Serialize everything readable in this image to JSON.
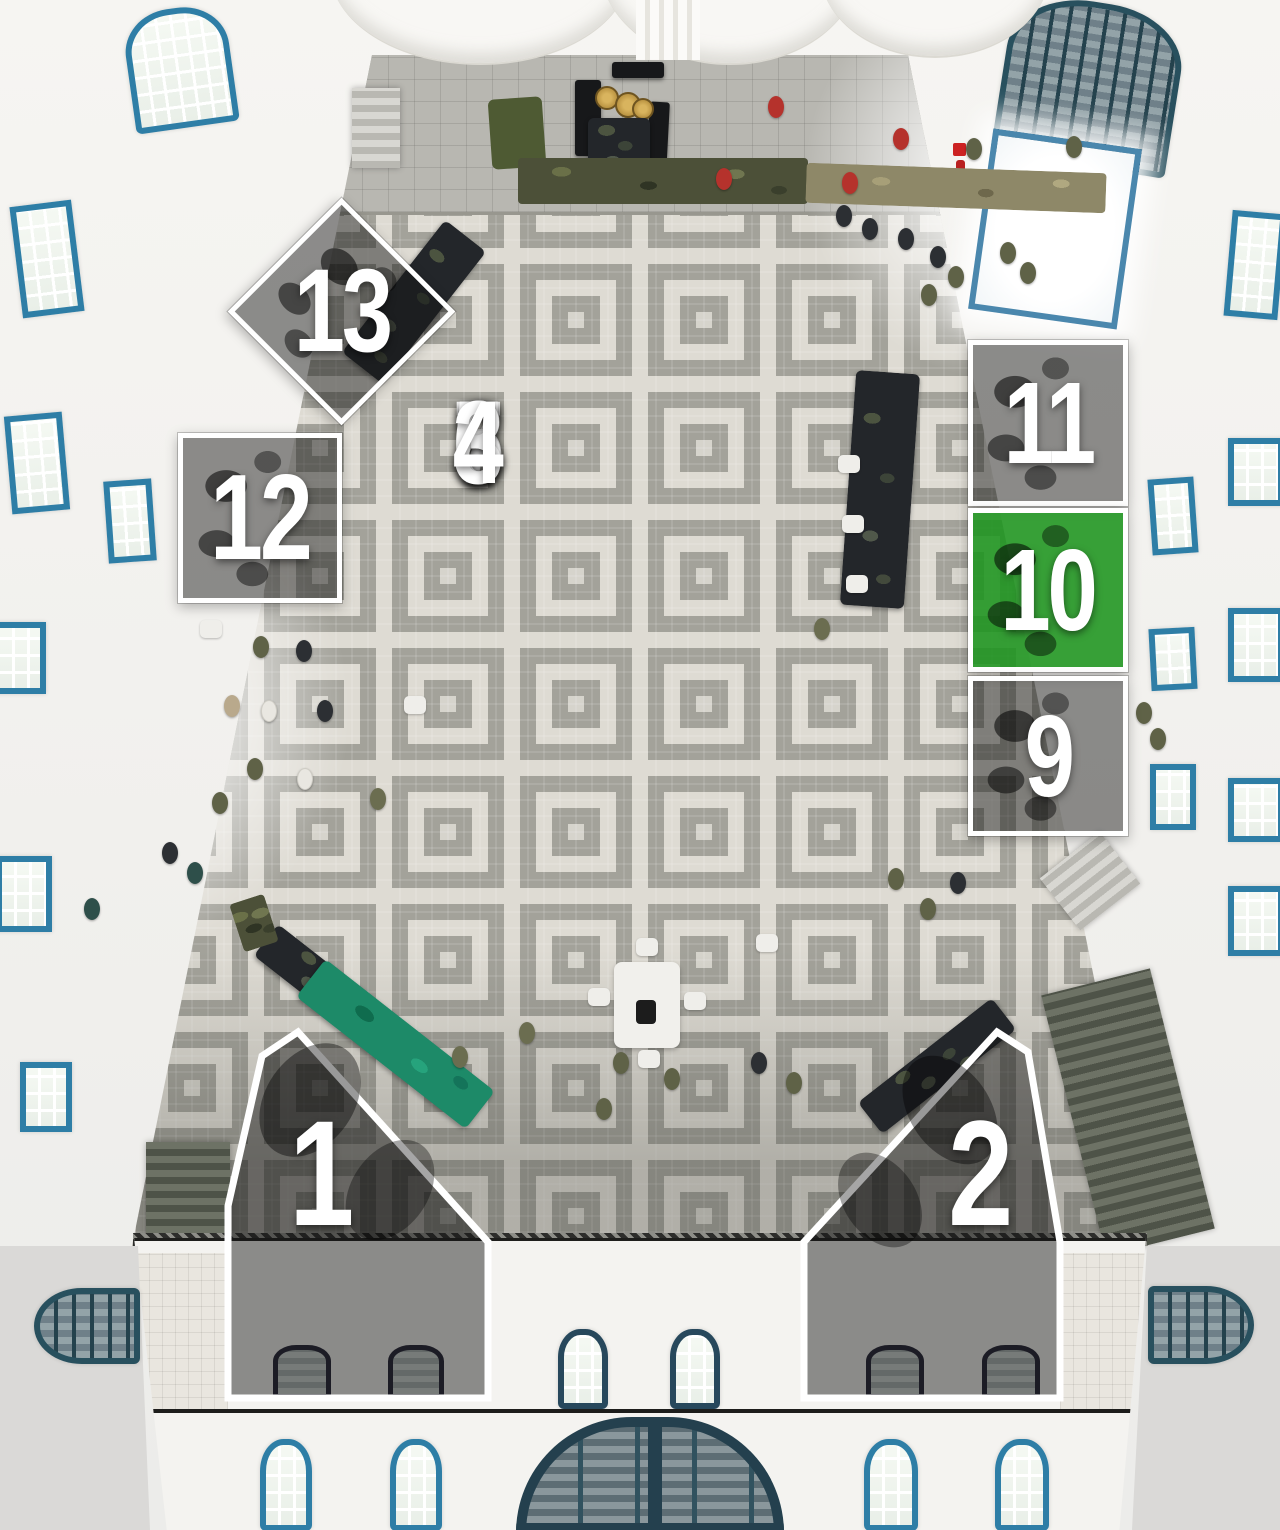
{
  "regions": [
    {
      "id": "1",
      "label": "1",
      "shape": "polygon",
      "highlighted": false
    },
    {
      "id": "2",
      "label": "2",
      "shape": "polygon",
      "highlighted": false
    },
    {
      "id": "3",
      "label": "3",
      "shape": "grid-cell",
      "highlighted": false
    },
    {
      "id": "4",
      "label": "4",
      "shape": "grid-cell",
      "highlighted": false
    },
    {
      "id": "5",
      "label": "5",
      "shape": "grid-cell",
      "highlighted": false
    },
    {
      "id": "6",
      "label": "6",
      "shape": "grid-cell",
      "highlighted": false
    },
    {
      "id": "7",
      "label": "7",
      "shape": "grid-cell",
      "highlighted": false
    },
    {
      "id": "8",
      "label": "8",
      "shape": "grid-cell",
      "highlighted": false
    },
    {
      "id": "9",
      "label": "9",
      "shape": "square",
      "highlighted": false
    },
    {
      "id": "10",
      "label": "10",
      "shape": "square",
      "highlighted": true
    },
    {
      "id": "11",
      "label": "11",
      "shape": "square",
      "highlighted": false
    },
    {
      "id": "12",
      "label": "12",
      "shape": "square",
      "highlighted": false
    },
    {
      "id": "13",
      "label": "13",
      "shape": "diamond",
      "highlighted": false
    }
  ],
  "highlighted_region": "10",
  "colors": {
    "region_border": "#ffffff",
    "region_dim": "rgba(22,22,22,0.47)",
    "highlight_green": "#1c941e",
    "number_text": "#ffffff",
    "window_blue": "#2e7ea6",
    "floor_gray": "#a3a29a",
    "floor_light": "#dedbd3"
  }
}
